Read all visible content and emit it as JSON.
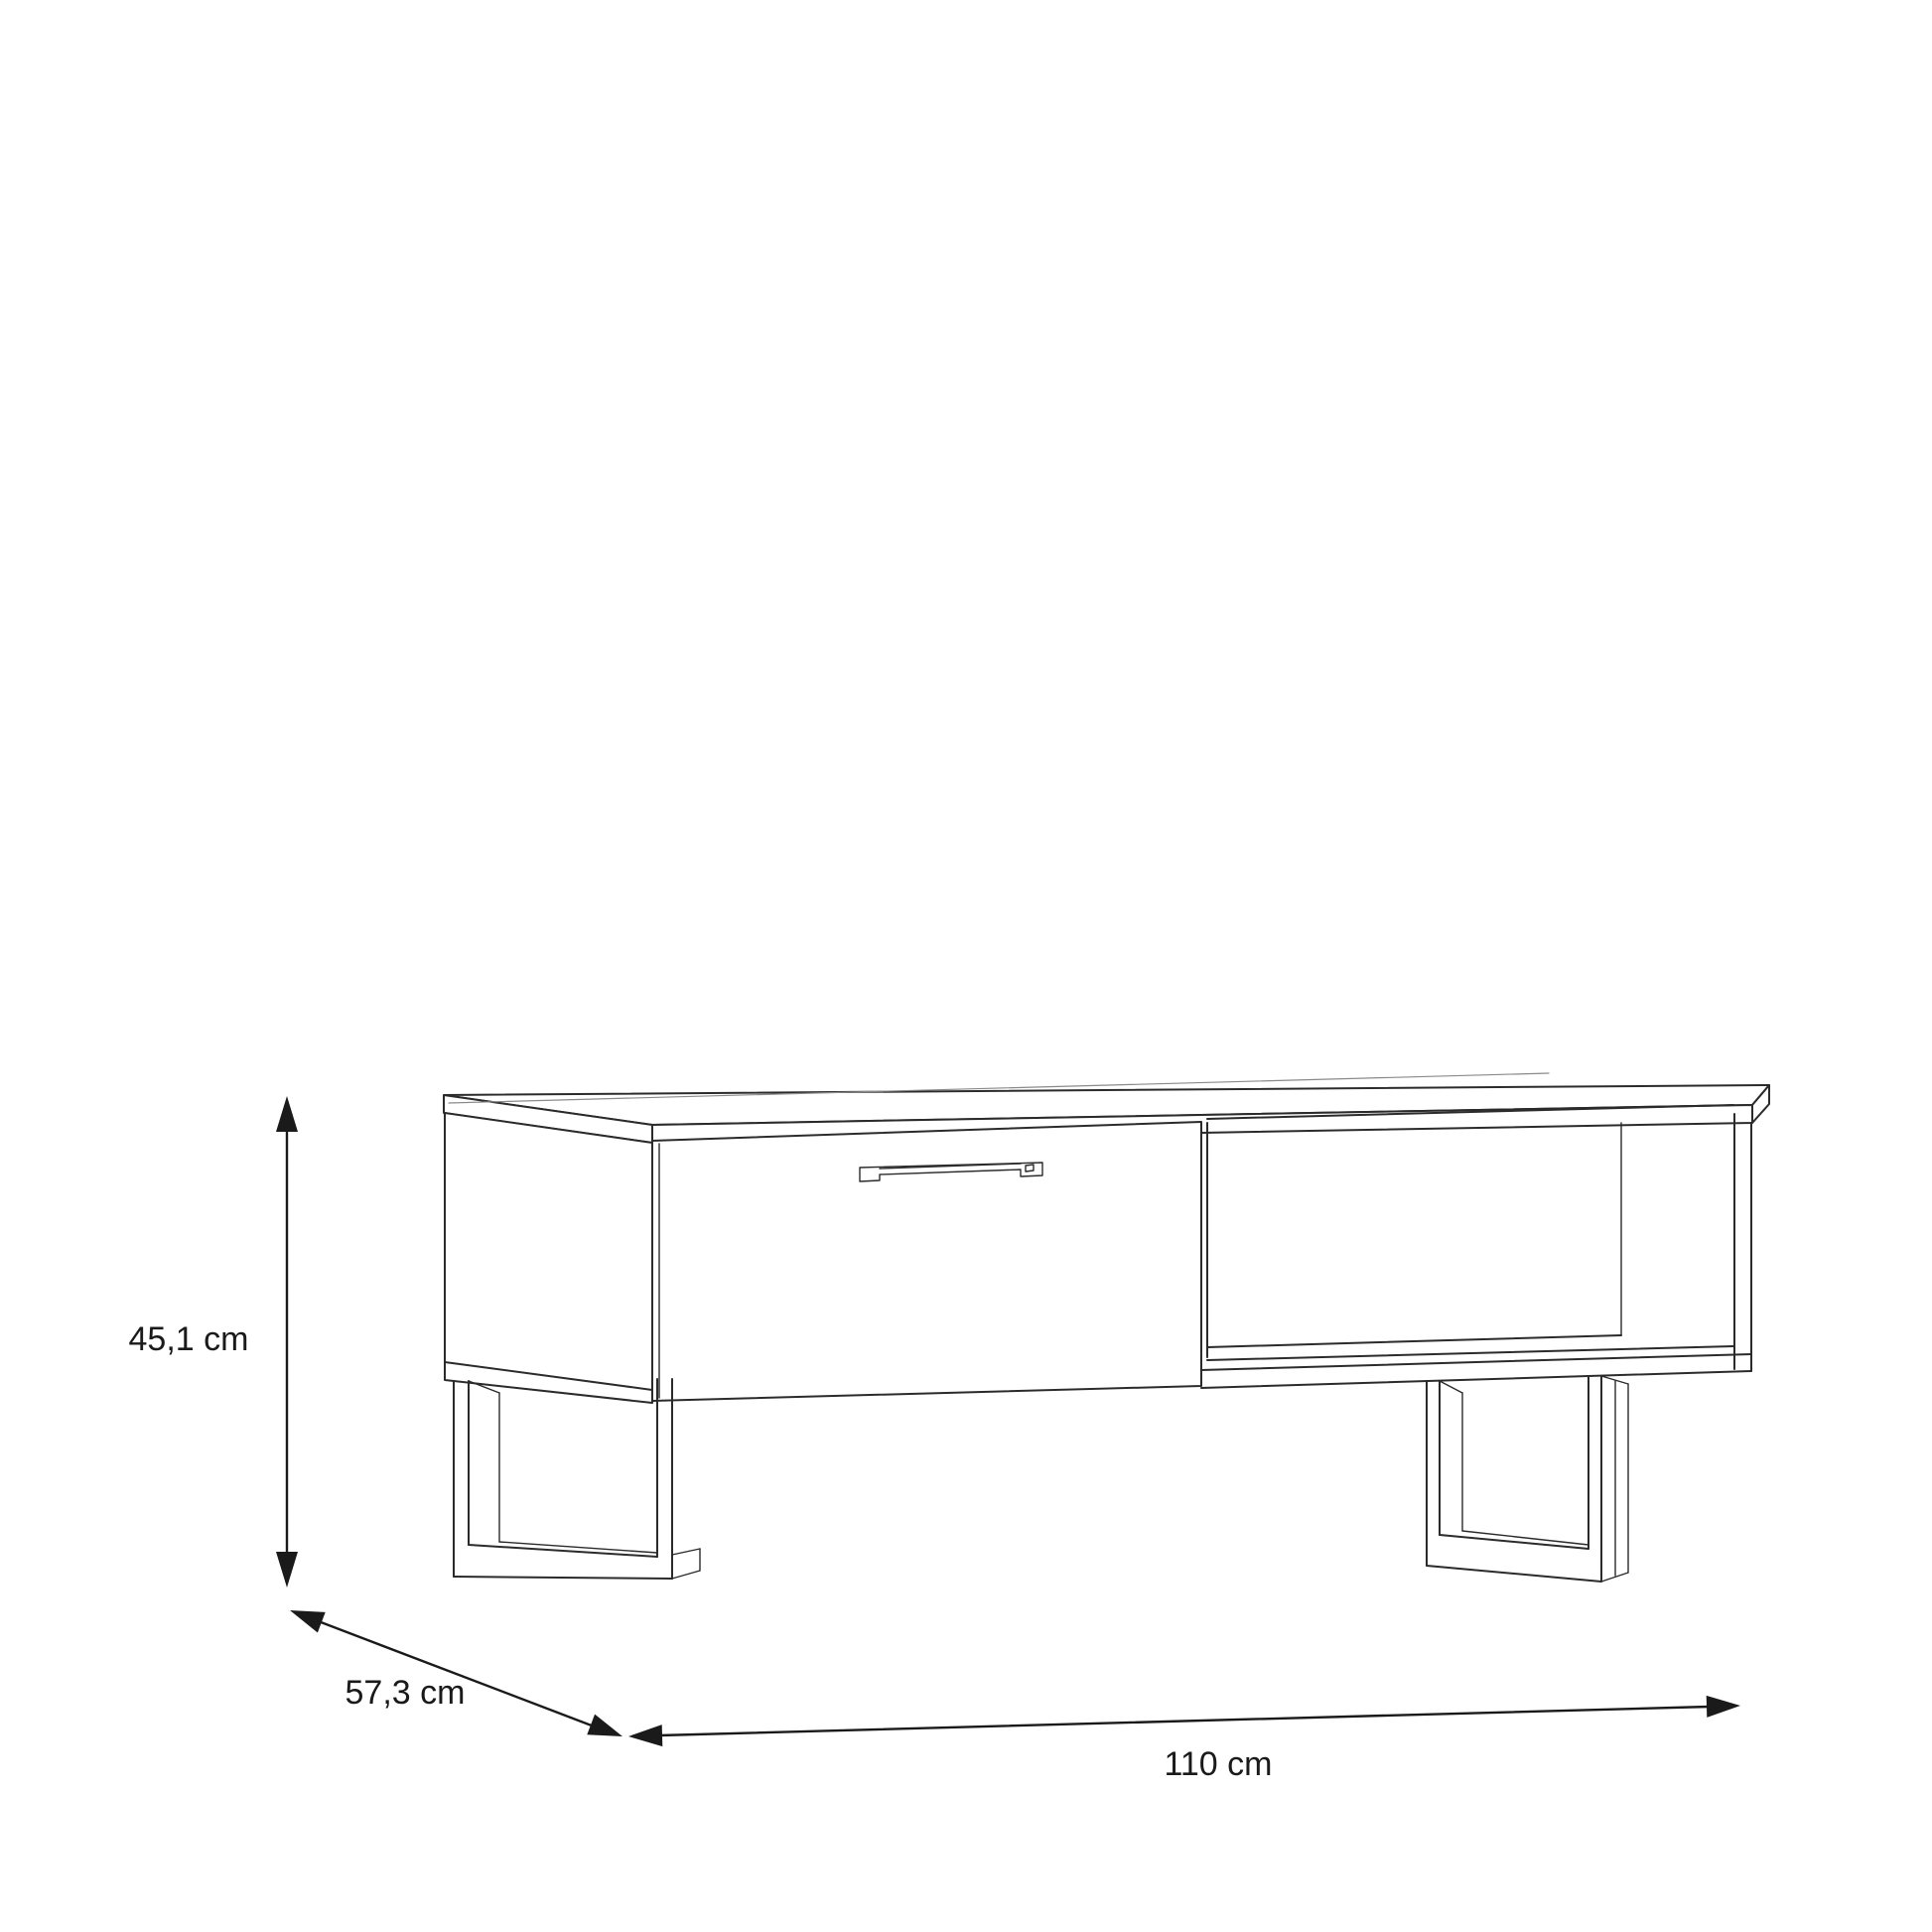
{
  "diagram": {
    "kind": "furniture-dimension-line-drawing",
    "item": "lowboard with one drawer, open shelf compartment, bar handle and two sled legs",
    "labels": {
      "height": "45,1 cm",
      "depth": "57,3 cm",
      "width": "110 cm"
    },
    "colors": {
      "background": "#ffffff",
      "line": "#2b2b2b",
      "line_light": "#8a8a8a",
      "text": "#1a1a1a"
    }
  }
}
